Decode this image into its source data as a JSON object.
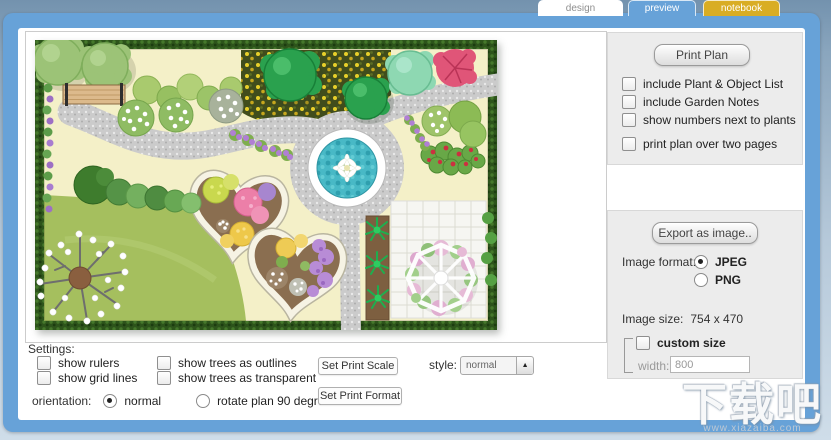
{
  "tabs": {
    "items": [
      {
        "label": "design",
        "active": false
      },
      {
        "label": "preview",
        "active": true
      },
      {
        "label": "notebook",
        "active": false
      }
    ]
  },
  "print_panel": {
    "print_button": "Print Plan",
    "options": [
      "include Plant & Object List",
      "include Garden Notes",
      "show numbers next to plants",
      "print plan over two pages"
    ],
    "export_button": "Export as image..",
    "image_format_label": "Image format:",
    "format_jpeg": "JPEG",
    "format_png": "PNG",
    "format_selected": "JPEG",
    "image_size_label": "Image size:",
    "image_size_value": "754 x 470",
    "custom_size_label": "custom size",
    "width_label": "width:",
    "width_value": "800"
  },
  "settings": {
    "title": "Settings:",
    "options": [
      "show rulers",
      "show grid lines",
      "show trees as outlines",
      "show trees as transparent"
    ],
    "orientation_label": "orientation:",
    "orientation_normal": "normal",
    "orientation_rotate": "rotate plan 90 degrees",
    "orientation_selected": "normal",
    "scale_button": "Set Print Scale",
    "format_button": "Set Print Format",
    "style_label": "style:",
    "style_value": "normal"
  },
  "watermark": {
    "brand": "下载吧",
    "site": "www.xiazaiba.com"
  },
  "plan_colors": {
    "lawn": "#f4f0c8",
    "grass": "#a5bf5e",
    "hedge": "#2d541b",
    "path": "#cbcbcb",
    "water": "#48b9c6",
    "accent_blue": "#67a2d8",
    "tab_gold": "#d9ad24"
  }
}
